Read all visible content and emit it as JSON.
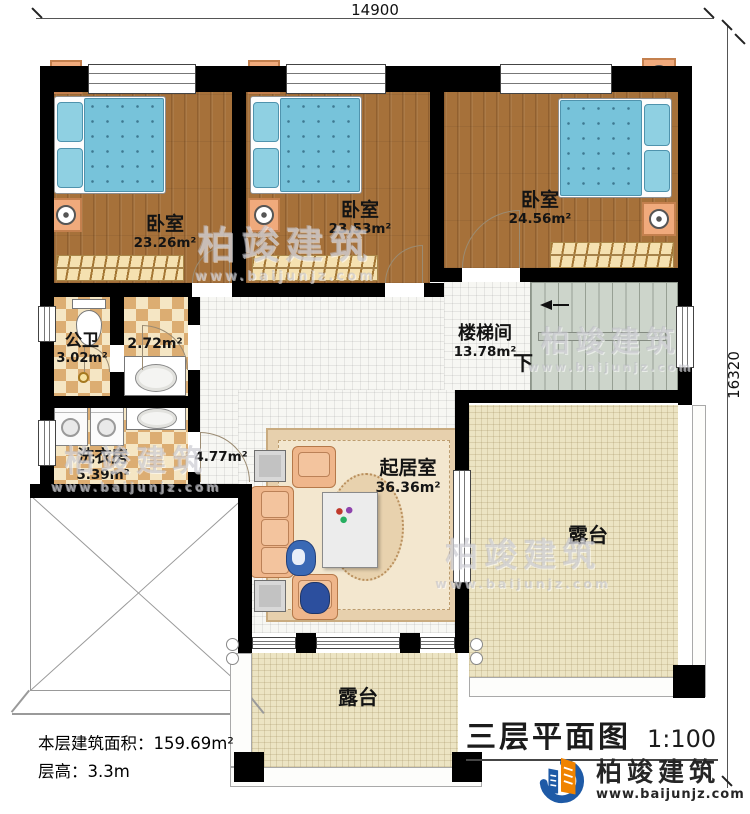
{
  "dimensions": {
    "top": "14900",
    "right": "16320"
  },
  "rooms": {
    "bedroom1": {
      "name": "卧室",
      "area": "23.26m²"
    },
    "bedroom2": {
      "name": "卧室",
      "area": "23.53m²"
    },
    "bedroom3": {
      "name": "卧室",
      "area": "24.56m²"
    },
    "bathroom": {
      "name": "公卫",
      "area": "3.02m²"
    },
    "washroom": {
      "area": "2.72m²"
    },
    "laundry": {
      "name": "洗衣房",
      "area": "5.39m²"
    },
    "hallway": {
      "area": "4.77m²"
    },
    "stairwell": {
      "name": "楼梯间",
      "area": "13.78m²",
      "down_label": "下"
    },
    "living_room": {
      "name": "起居室",
      "area": "36.36m²"
    },
    "terrace_right": {
      "name": "露台"
    },
    "terrace_bottom": {
      "name": "露台"
    }
  },
  "notes": {
    "floor_area": "本层建筑面积：159.69m²",
    "floor_height": "层高：3.3m"
  },
  "title_block": {
    "title": "三层平面图",
    "scale": "1:100"
  },
  "brand": {
    "name": "柏竣建筑",
    "website": "www.baijunjz.com",
    "orange": "#f08300",
    "blue": "#1e5aa6"
  },
  "colors": {
    "wall": "#000000",
    "wood_floor": "#a6713a",
    "checker_light": "#f5e6c4",
    "checker_dark": "#dcad72",
    "tile_floor": "#f7f7f3",
    "terrace_floor": "#ece4c3",
    "stair_floor": "#cdd5cb",
    "bed_blue": "#77c3da"
  }
}
